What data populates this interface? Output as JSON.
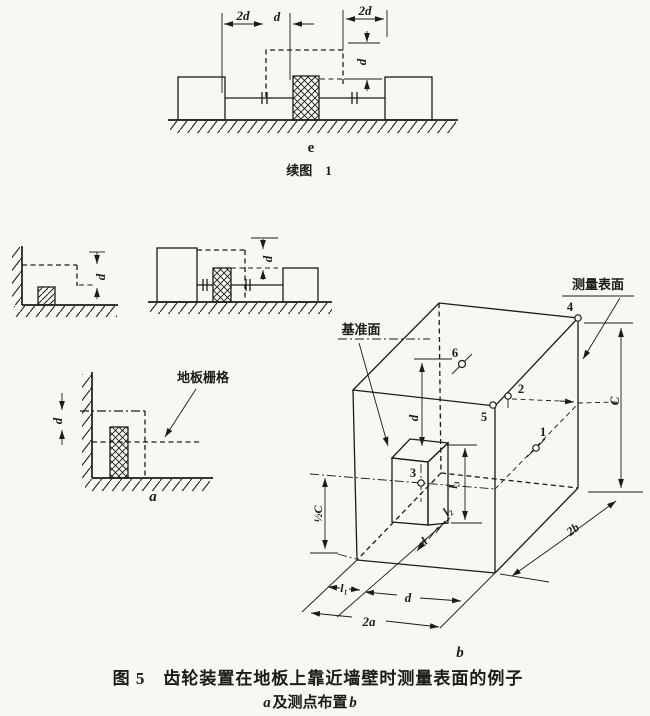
{
  "page": {
    "bg": "#f8f7f3",
    "ink": "#1d1b18"
  },
  "figure_e": {
    "label": "e",
    "caption": "续图　1",
    "dim_2d_left": "2d",
    "dim_d_gap": "d",
    "dim_2d_right": "2d",
    "dim_d_vertical": "d"
  },
  "figure_wall": {
    "dim_d": "d"
  },
  "figure_shaft": {
    "dim_d": "d"
  },
  "figure_a": {
    "label": "a",
    "floor_grid": "地板栅格",
    "dim_d": "d"
  },
  "figure_b": {
    "label": "b",
    "datum_plane": "基准面",
    "measure_surface": "测量表面",
    "points": {
      "p1": "1",
      "p2": "2",
      "p3": "3",
      "p4": "4",
      "p5": "5",
      "p6": "6"
    },
    "dim_d_vertical": "d",
    "dim_l3": "l₃",
    "dim_half_c": "½C",
    "dim_c": "C",
    "dim_l2": "l₂",
    "dim_d_depth": "d",
    "dim_l1": "l₁",
    "dim_d_bottom": "d",
    "dim_2a": "2a",
    "dim_2b": "2b"
  },
  "caption": {
    "line1": "图 5　齿轮装置在地板上靠近墙壁时测量表面的例子",
    "line2_a": "a",
    "line2_mid": "及测点布置",
    "line2_b": "b"
  }
}
